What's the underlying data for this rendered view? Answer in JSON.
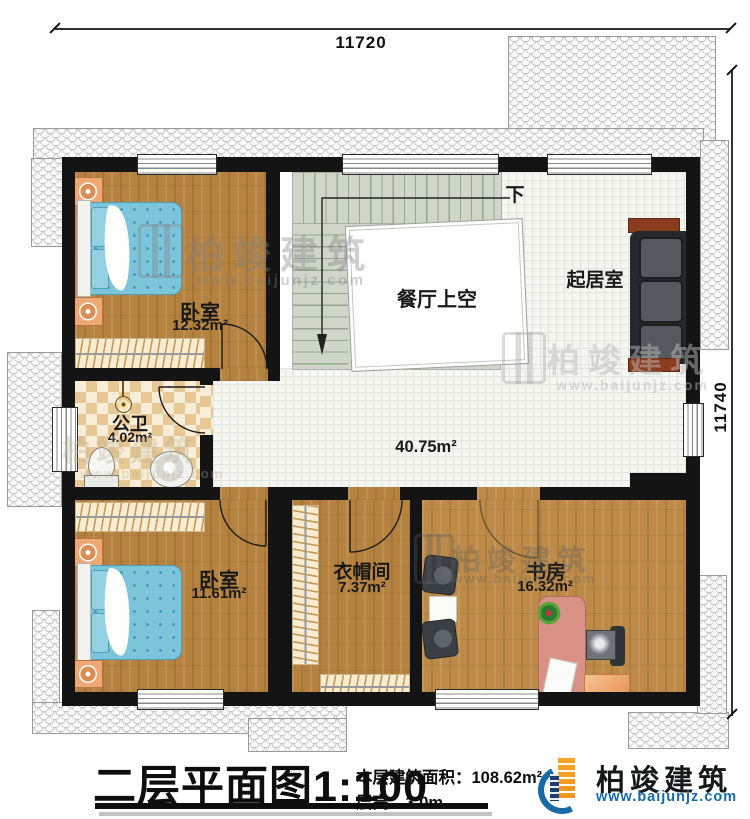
{
  "dimensions": {
    "top": "11720",
    "right": "11740"
  },
  "rooms": {
    "bedroom1": {
      "name": "卧室",
      "area": "12.32m²"
    },
    "bathroom": {
      "name": "公卫",
      "area": "4.02m²"
    },
    "bedroom2": {
      "name": "卧室",
      "area": "11.61m²"
    },
    "closet": {
      "name": "衣帽间",
      "area": "7.37m²"
    },
    "study": {
      "name": "书房",
      "area": "16.32m²"
    },
    "living": {
      "name": "起居室"
    },
    "void": {
      "name": "餐厅上空"
    },
    "hall": {
      "area": "40.75m²"
    },
    "stairs": {
      "down_label": "下"
    }
  },
  "title_block": {
    "plan_title": "二层平面图",
    "scale": "1:100",
    "area_label": "本层建筑面积：",
    "area_value": "108.62m²",
    "height_label": "层高：",
    "height_value": "3.0m"
  },
  "logo": {
    "name": "柏竣建筑",
    "url": "www.baijunjz.com"
  },
  "watermark": {
    "text": "柏竣建筑",
    "url": "www.baijunjz.com"
  },
  "colors": {
    "wood_floor": "#b5823f",
    "bed_teal": "#7cc4da",
    "stairs_green": "#cfd6c9",
    "wall_black": "#141414",
    "logo_blue": "#1769a8",
    "logo_orange": "#f29422",
    "bath_tile_tan": "#e7c793"
  }
}
